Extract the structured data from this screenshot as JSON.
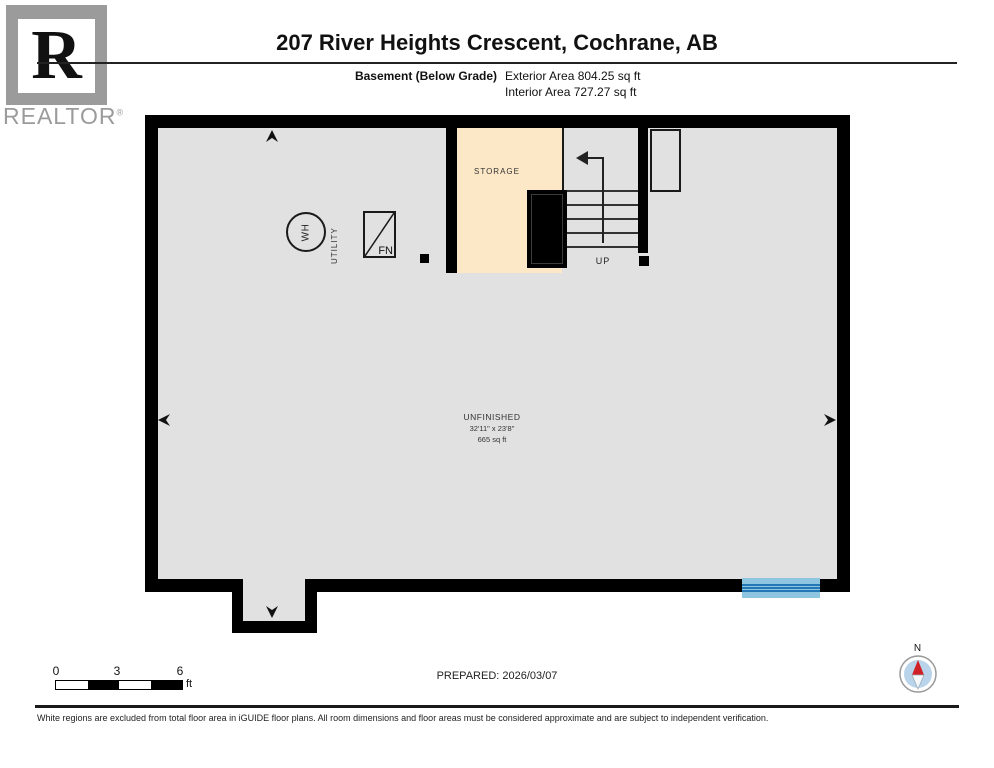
{
  "header": {
    "logo_letter": "R",
    "logo_wordmark": "REALTOR",
    "logo_registered": "®",
    "title": "207 River Heights Crescent, Cochrane, AB",
    "floor_label": "Basement (Below Grade)",
    "exterior_area": "Exterior Area 804.25 sq ft",
    "interior_area": "Interior Area 727.27 sq ft"
  },
  "plan": {
    "storage_label": "STORAGE",
    "utility_label": "UTILITY",
    "water_heater_label": "WH",
    "furnace_label": "FN",
    "up_label": "UP",
    "unfinished_room": {
      "name": "UNFINISHED",
      "dimensions": "32'11\" x 23'8\"",
      "area": "665 sq ft"
    }
  },
  "footer": {
    "scale_ticks": [
      "0",
      "3",
      "6"
    ],
    "scale_unit": "ft",
    "prepared": "PREPARED: 2026/03/07",
    "compass_label": "N",
    "disclaimer": "White regions are excluded from total floor area in iGUIDE floor plans. All room dimensions and floor areas must be considered approximate and are subject to independent verification."
  },
  "colors": {
    "floor": "#e1e1e1",
    "storage": "#fce8c6",
    "wall": "#000000",
    "window_light": "#8ec6e2",
    "window_dark": "#2278b5",
    "compass_disc": "#b9d3ea",
    "compass_needle": "#cf2027",
    "logo_gray": "#9b9b9b"
  }
}
